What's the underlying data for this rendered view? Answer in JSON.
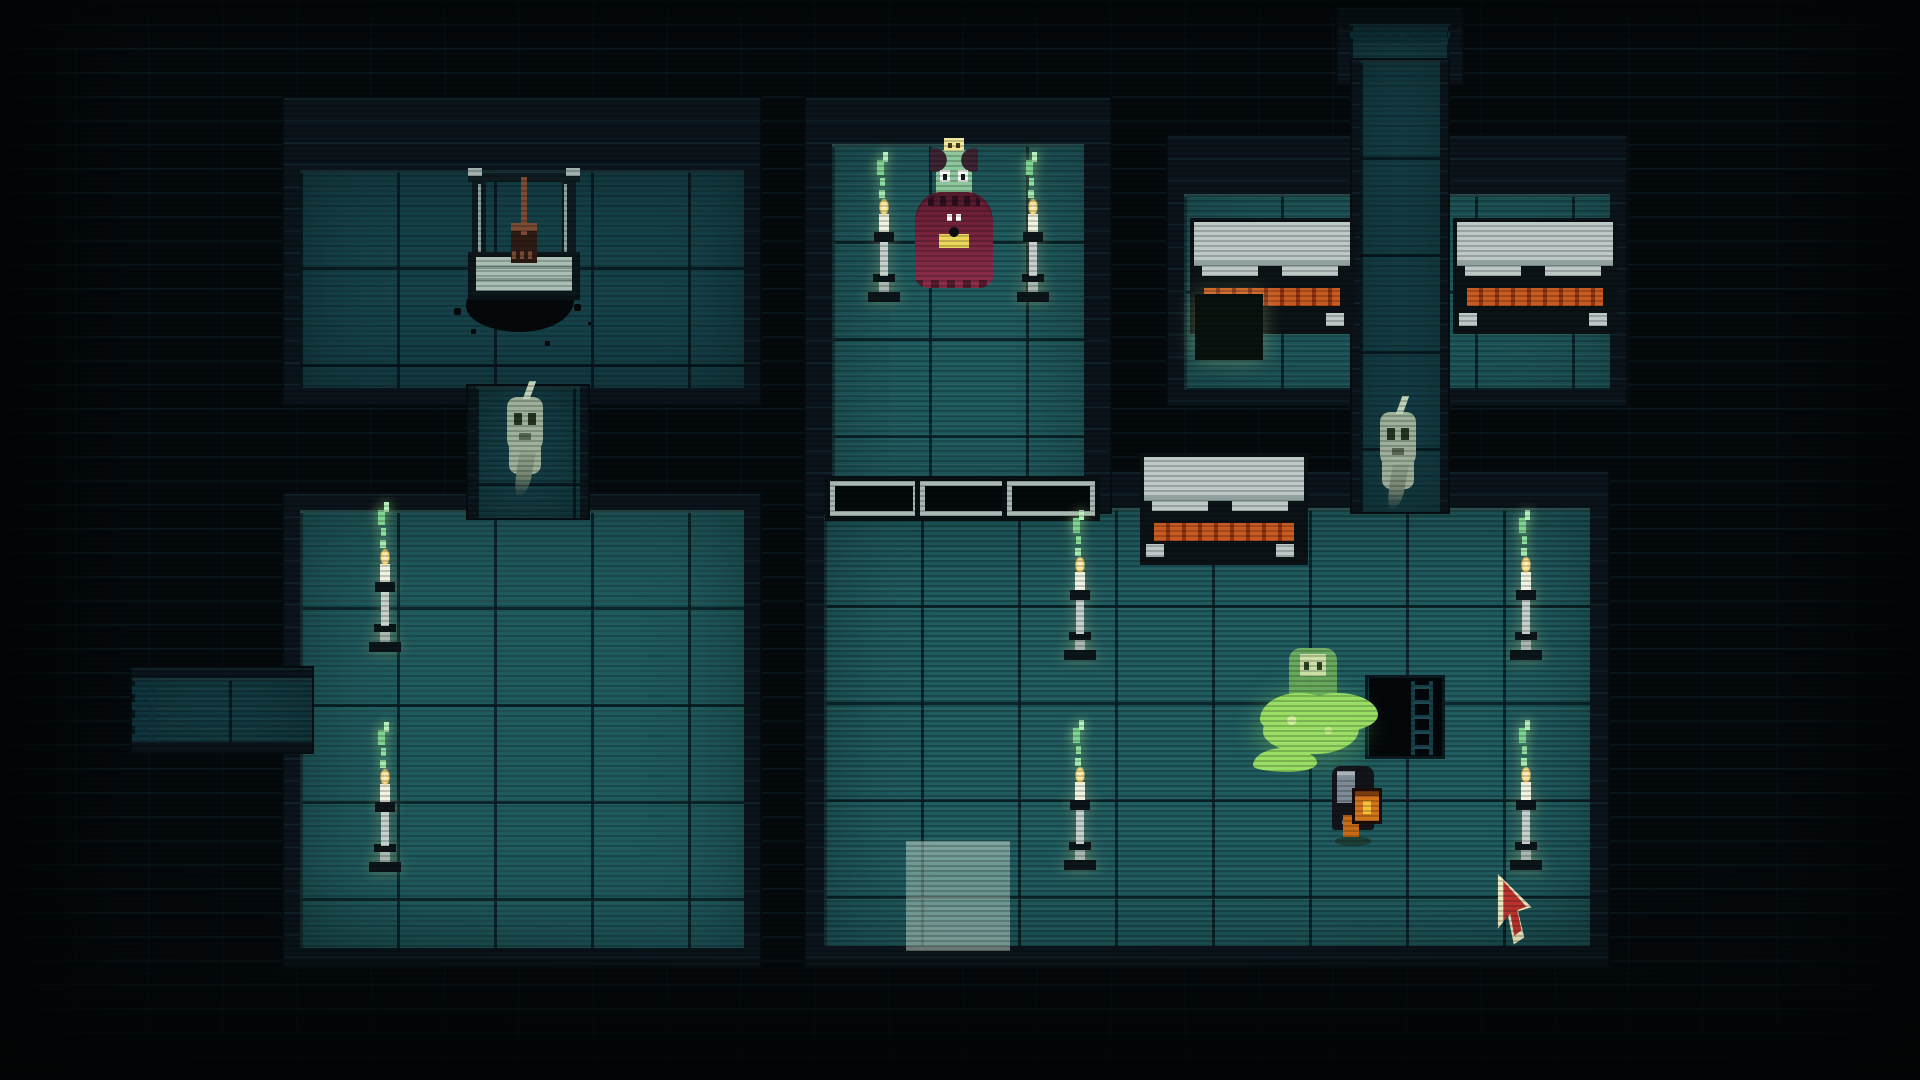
{
  "meta": {
    "scene": "pixel-art-dungeon-crypt",
    "viewport": {
      "width": 1920,
      "height": 1080
    },
    "hud_text": []
  },
  "palette": {
    "background": "#04090c",
    "wall": "#0a141a",
    "floor_bright": "#1f5a5e",
    "floor_dim": "#154149",
    "grid_line": "#0a2228",
    "skull_gold": "#f2e79b",
    "skull_pale": "#dde8ae",
    "candle_flame": "#ffe9a0",
    "candle_wisp_green": "#8fdf9f",
    "coffin_lid": "#bcc9c7",
    "coffin_trim_orange": "#c95a22",
    "priestess_dress": "#7c2740",
    "priestess_skin": "#8cc79c",
    "emblem_yellow": "#ecd75a",
    "ghost_body": "#a9baa2",
    "slime_green": "#9ade66",
    "knight_armor": "#14141b",
    "knight_lantern": "#d2741c",
    "cursor_red": "#bf3430",
    "cursor_outline": "#f2ecc2"
  },
  "rooms": [
    {
      "id": "room-top-left",
      "x": 284,
      "y": 98,
      "w": 476,
      "h": 306,
      "wall": {
        "t": 72,
        "r": 16,
        "b": 16,
        "l": 16
      },
      "floor": "dim",
      "checker": ""
    },
    {
      "id": "room-bottom-left",
      "x": 284,
      "y": 494,
      "w": 476,
      "h": 472,
      "wall": {
        "t": 16,
        "r": 16,
        "b": 18,
        "l": 16
      },
      "floor": "bright",
      "checker": ""
    },
    {
      "id": "corridor-left-vertical",
      "x": 468,
      "y": 386,
      "w": 120,
      "h": 132,
      "wall": {
        "t": 0,
        "r": 8,
        "b": 0,
        "l": 8
      },
      "floor": "dim",
      "checker": ""
    },
    {
      "id": "corridor-west-stub",
      "x": 132,
      "y": 668,
      "w": 180,
      "h": 84,
      "wall": {
        "t": 10,
        "r": 0,
        "b": 10,
        "l": 0
      },
      "floor": "dim",
      "checker": "checker-left"
    },
    {
      "id": "room-big-south",
      "x": 806,
      "y": 472,
      "w": 802,
      "h": 494,
      "wall": {
        "t": 36,
        "r": 18,
        "b": 20,
        "l": 18
      },
      "floor": "bright",
      "checker": ""
    },
    {
      "id": "room-altar-north",
      "x": 806,
      "y": 98,
      "w": 304,
      "h": 414,
      "wall": {
        "t": 46,
        "r": 26,
        "b": 0,
        "l": 26
      },
      "floor": "bright",
      "checker": ""
    },
    {
      "id": "room-coffins-northeast",
      "x": 1168,
      "y": 136,
      "w": 458,
      "h": 270,
      "wall": {
        "t": 58,
        "r": 16,
        "b": 16,
        "l": 16
      },
      "floor": "bright",
      "checker": ""
    },
    {
      "id": "room-tiny-north",
      "x": 1338,
      "y": 8,
      "w": 124,
      "h": 76,
      "wall": {
        "t": 16,
        "r": 12,
        "b": 0,
        "l": 12
      },
      "floor": "dim",
      "checker": "checker-top"
    },
    {
      "id": "corridor-north-vertical",
      "x": 1352,
      "y": 60,
      "w": 96,
      "h": 452,
      "wall": {
        "t": 0,
        "r": 8,
        "b": 0,
        "l": 8
      },
      "floor": "dim",
      "checker": ""
    }
  ],
  "entities": [
    {
      "type": "skull",
      "variant": "gold",
      "name": "wall-skull-top-left",
      "x": 300,
      "y": 126,
      "w": 50,
      "h": 54
    },
    {
      "type": "skull",
      "variant": "gold",
      "name": "wall-skull-bottom-left-room",
      "x": 402,
      "y": 472,
      "w": 50,
      "h": 50
    },
    {
      "type": "skull",
      "variant": "gold",
      "name": "wall-skull-big-room-east",
      "x": 1570,
      "y": 472,
      "w": 50,
      "h": 50
    },
    {
      "type": "skull",
      "variant": "pale",
      "name": "floor-skull-coffin-room",
      "x": 1203,
      "y": 300,
      "w": 50,
      "h": 50
    },
    {
      "type": "well",
      "variant": "",
      "name": "stone-well",
      "x": 468,
      "y": 168,
      "w": 112,
      "h": 130
    },
    {
      "type": "spill",
      "variant": "",
      "name": "black-spill",
      "x": 446,
      "y": 260,
      "w": 150,
      "h": 88
    },
    {
      "type": "priestess",
      "variant": "",
      "name": "priestess-npc",
      "x": 915,
      "y": 138,
      "w": 78,
      "h": 150
    },
    {
      "type": "candle",
      "variant": "",
      "name": "candle-altar-left",
      "x": 864,
      "y": 152,
      "w": 40,
      "h": 150
    },
    {
      "type": "candle",
      "variant": "",
      "name": "candle-altar-right",
      "x": 1013,
      "y": 152,
      "w": 40,
      "h": 150
    },
    {
      "type": "candle",
      "variant": "",
      "name": "candle-west-room-north",
      "x": 365,
      "y": 502,
      "w": 40,
      "h": 150
    },
    {
      "type": "candle",
      "variant": "",
      "name": "candle-west-room-south",
      "x": 365,
      "y": 722,
      "w": 40,
      "h": 150
    },
    {
      "type": "candle",
      "variant": "",
      "name": "candle-big-room-northwest",
      "x": 1060,
      "y": 510,
      "w": 40,
      "h": 150
    },
    {
      "type": "candle",
      "variant": "",
      "name": "candle-big-room-southwest",
      "x": 1060,
      "y": 720,
      "w": 40,
      "h": 150
    },
    {
      "type": "candle",
      "variant": "",
      "name": "candle-big-room-northeast",
      "x": 1506,
      "y": 510,
      "w": 40,
      "h": 150
    },
    {
      "type": "candle",
      "variant": "",
      "name": "candle-big-room-southeast",
      "x": 1506,
      "y": 720,
      "w": 40,
      "h": 150
    },
    {
      "type": "ghost",
      "variant": "",
      "name": "ghost-west-corridor",
      "x": 500,
      "y": 385,
      "w": 50,
      "h": 112
    },
    {
      "type": "ghost",
      "variant": "",
      "name": "ghost-north-corridor",
      "x": 1373,
      "y": 400,
      "w": 50,
      "h": 110
    },
    {
      "type": "coffin",
      "variant": "",
      "name": "coffin-left",
      "x": 1190,
      "y": 218,
      "w": 156,
      "h": 108
    },
    {
      "type": "coffin",
      "variant": "",
      "name": "coffin-right",
      "x": 1453,
      "y": 218,
      "w": 156,
      "h": 108
    },
    {
      "type": "coffin",
      "variant": "",
      "name": "coffin-center",
      "x": 1140,
      "y": 453,
      "w": 160,
      "h": 104
    },
    {
      "type": "slot",
      "variant": "",
      "name": "wall-slot-1",
      "x": 830,
      "y": 481,
      "w": 78,
      "h": 25
    },
    {
      "type": "slot",
      "variant": "",
      "name": "wall-slot-2",
      "x": 920,
      "y": 481,
      "w": 78,
      "h": 25
    },
    {
      "type": "slot",
      "variant": "",
      "name": "wall-slot-3",
      "x": 1007,
      "y": 481,
      "w": 78,
      "h": 25
    },
    {
      "type": "slime",
      "variant": "",
      "name": "slime-ghost",
      "x": 1263,
      "y": 648,
      "w": 96,
      "h": 112
    },
    {
      "type": "knight",
      "variant": "",
      "name": "player-knight",
      "x": 1326,
      "y": 766,
      "w": 54,
      "h": 80
    },
    {
      "type": "pit",
      "variant": "",
      "name": "floor-pit",
      "x": 1365,
      "y": 675,
      "w": 80,
      "h": 84
    },
    {
      "type": "highlight",
      "variant": "",
      "name": "tile-highlight",
      "x": 906,
      "y": 841,
      "w": 104,
      "h": 110
    },
    {
      "type": "cursor",
      "variant": "",
      "name": "mouse-cursor",
      "x": 1496,
      "y": 874,
      "w": 48,
      "h": 72
    }
  ]
}
